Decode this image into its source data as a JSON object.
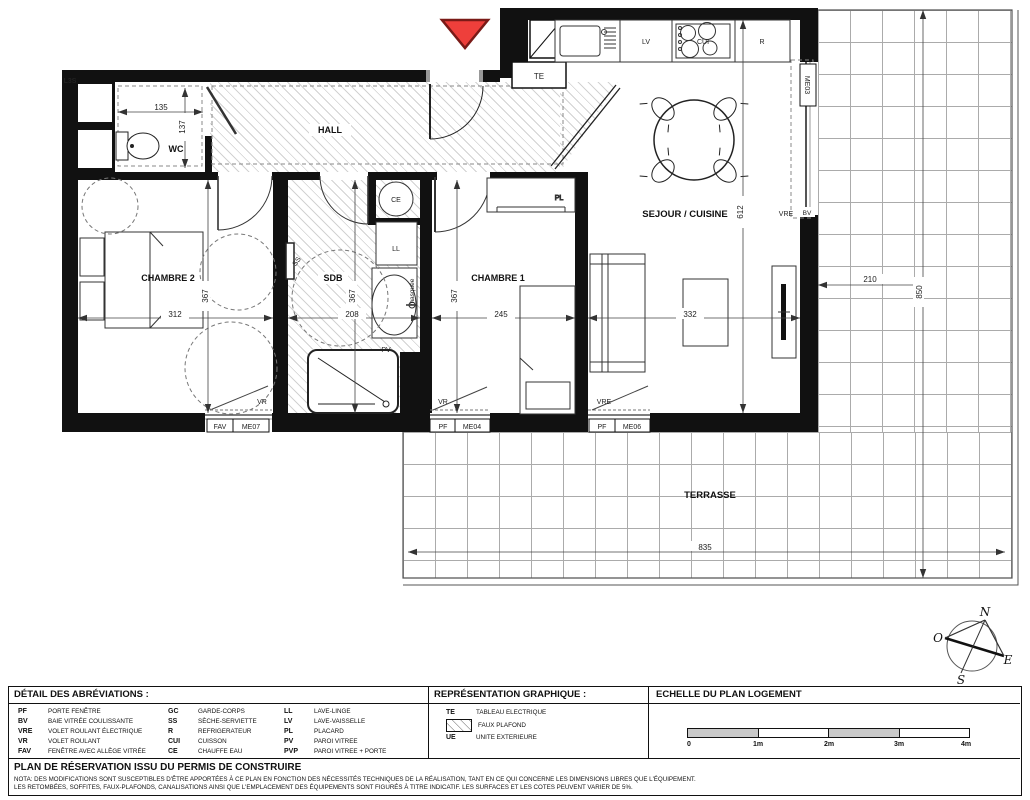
{
  "plan": {
    "corner_label": "L3S",
    "rooms": {
      "hall": "HALL",
      "wc": "WC",
      "chambre2": "CHAMBRE 2",
      "sdb": "SDB",
      "chambre1": "CHAMBRE 1",
      "sejour": "SEJOUR / CUISINE",
      "terrasse": "TERRASSE"
    },
    "fixtures": {
      "te": "TE",
      "ce": "CE",
      "ll": "LL",
      "lv": "LV",
      "cui": "CUI",
      "r": "R",
      "ss": "SS",
      "pv": "PV",
      "pl": "PL",
      "masquee": "masquée"
    },
    "dims": {
      "wc_w": "135",
      "wc_h": "137",
      "ch2_w": "312",
      "ch2_h": "367",
      "sdb_w": "208",
      "sdb_h": "367",
      "ch1_w": "245",
      "ch1_h": "367",
      "sejour_w": "332",
      "sejour_h": "612",
      "terrasse_side_w": "210",
      "terrasse_side_h": "850",
      "terrasse_w": "835"
    },
    "windows": {
      "bay_label": "ME03",
      "bay_vre": "VRE",
      "bay_bv": "BV",
      "w1_vr": "VR",
      "w1_type": "FAV",
      "w1_code": "ME07",
      "w2_vr": "VR",
      "w2_type": "PF",
      "w2_code": "ME04",
      "w3_vr": "VRE",
      "w3_type": "PF",
      "w3_code": "ME06"
    },
    "compass": {
      "n": "N",
      "o": "O",
      "e": "E",
      "s": "S"
    }
  },
  "legend": {
    "abbrev_title": "DÉTAIL DES ABRÉVIATIONS :",
    "col1": [
      {
        "a": "PF",
        "l": "PORTE FENÊTRE"
      },
      {
        "a": "BV",
        "l": "BAIE VITRÉE COULISSANTE"
      },
      {
        "a": "VRE",
        "l": "VOLET ROULANT ÉLECTRIQUE"
      },
      {
        "a": "VR",
        "l": "VOLET ROULANT"
      },
      {
        "a": "FAV",
        "l": "FENÊTRE AVEC ALLÈGE VITRÉE"
      }
    ],
    "col2": [
      {
        "a": "GC",
        "l": "GARDE-CORPS"
      },
      {
        "a": "SS",
        "l": "SÈCHE-SERVIETTE"
      },
      {
        "a": "R",
        "l": "REFRIGERATEUR"
      },
      {
        "a": "CUI",
        "l": "CUISSON"
      },
      {
        "a": "CE",
        "l": "CHAUFFE EAU"
      }
    ],
    "col3": [
      {
        "a": "LL",
        "l": "LAVE-LINGE"
      },
      {
        "a": "LV",
        "l": "LAVE-VAISSELLE"
      },
      {
        "a": "PL",
        "l": "PLACARD"
      },
      {
        "a": "PV",
        "l": "PAROI VITREE"
      },
      {
        "a": "PVP",
        "l": "PAROI VITREE + PORTE"
      }
    ],
    "graphic_title": "REPRÉSENTATION GRAPHIQUE :",
    "graphic_items": {
      "te_abbr": "TE",
      "te_label": "TABLEAU ELECTRIQUE",
      "fp_label": "FAUX PLAFOND",
      "ue_abbr": "UE",
      "ue_label": "UNITE EXTERIEURE"
    },
    "scale_title": "ECHELLE DU PLAN LOGEMENT",
    "scale_ticks": [
      "0",
      "1m",
      "2m",
      "3m",
      "4m"
    ],
    "plan_title": "PLAN DE RÉSERVATION ISSU DU PERMIS DE CONSTRUIRE",
    "nota1": "NOTA: DES MODIFICATIONS SONT SUSCEPTIBLES D'ÊTRE APPORTÉES À CE PLAN EN FONCTION DES NÉCESSITÉS TECHNIQUES DE LA RÉALISATION, TANT EN CE QUI CONCERNE LES DIMENSIONS LIBRES QUE L'ÉQUIPEMENT.",
    "nota2": "LES RETOMBÉES, SOFFITES, FAUX-PLAFONDS, CANALISATIONS AINSI QUE L'EMPLACEMENT DES ÉQUIPEMENTS SONT FIGURÉS À TITRE INDICATIF. LES SURFACES ET LES COTES PEUVENT VARIER DE 5%."
  },
  "colors": {
    "wall": "#111111",
    "entrance_marker": "#ee3f3b",
    "entrance_marker_border": "#7a1a17"
  }
}
